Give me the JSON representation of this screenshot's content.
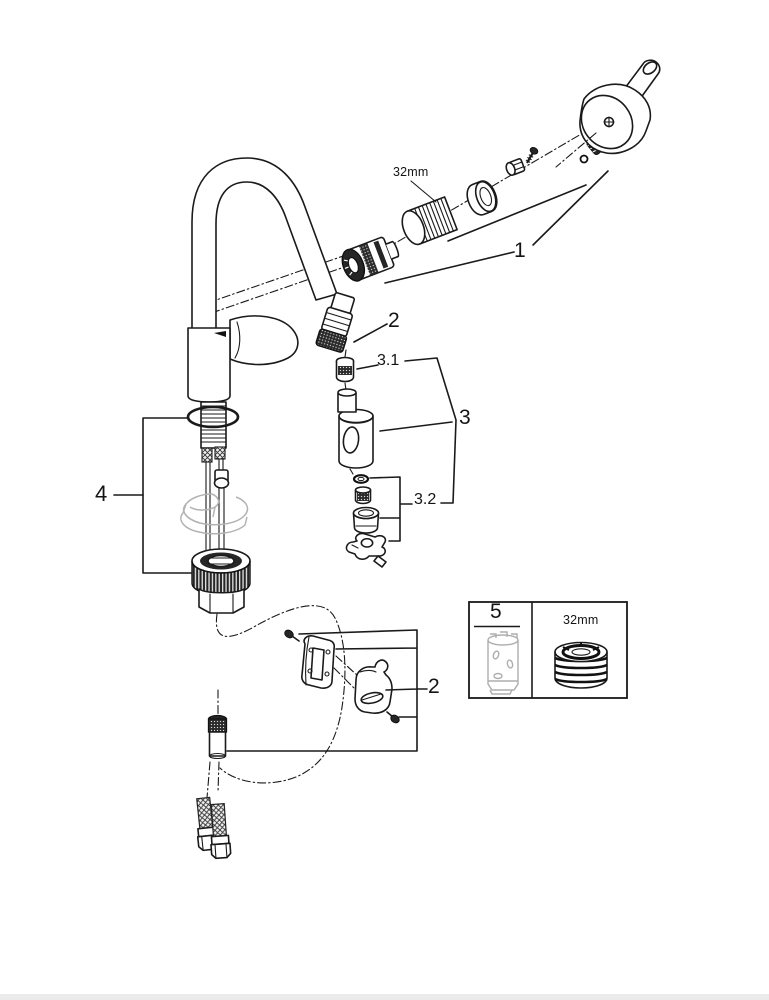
{
  "page": {
    "background": "#ffffff",
    "footer_bar_color": "#ebebeb",
    "line_color": "#1a1a1a",
    "gray_part_color": "#b3b3b3"
  },
  "diagram": {
    "kind": "kitchen faucet exploded parts diagram",
    "callouts": {
      "c1": "1",
      "c2_upper": "2",
      "c3_1": "3.1",
      "c3": "3",
      "c3_2": "3.2",
      "c4": "4",
      "c2_lower": "2",
      "c5": "5"
    },
    "size_labels": {
      "top": "32mm",
      "box": "32mm"
    }
  }
}
